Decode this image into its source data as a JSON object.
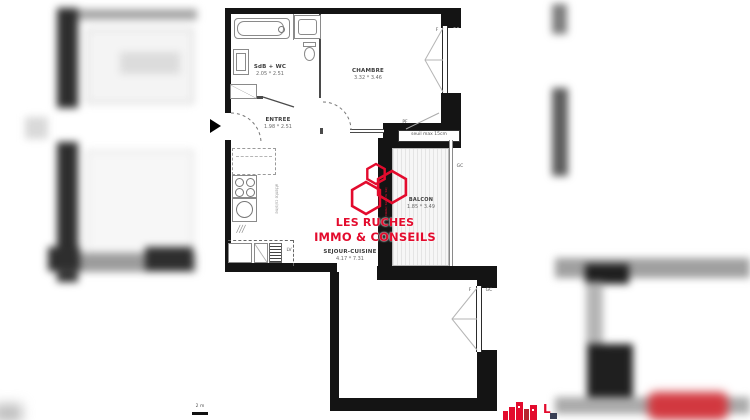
{
  "plan": {
    "rooms": {
      "sdb": {
        "name": "SdB + WC",
        "dims": "2.05 * 2.51"
      },
      "chambre": {
        "name": "CHAMBRE",
        "dims": "3.32 * 3.46"
      },
      "entree": {
        "name": "ENTREE",
        "dims": "1.98 * 2.51"
      },
      "sejour": {
        "name": "SEJOUR-CUISINE",
        "dims": "4.17 * 7.31"
      },
      "balcon": {
        "name": "BALCON",
        "dims": "1.85 * 3.49"
      }
    },
    "annotations": {
      "seuil": "seuil max 15cm",
      "pf": "PF",
      "f": "F",
      "gc": "GC",
      "lv": "LV",
      "attente": "attente cuisine",
      "scale": "2 m"
    },
    "colors": {
      "wall": "#141414",
      "accent": "#e30b2d"
    }
  },
  "watermark": {
    "line1": "LES RUCHES",
    "line2": "IMMO & CONSEILS",
    "vertical": "les ruches immo",
    "fragment_letter": "L"
  }
}
